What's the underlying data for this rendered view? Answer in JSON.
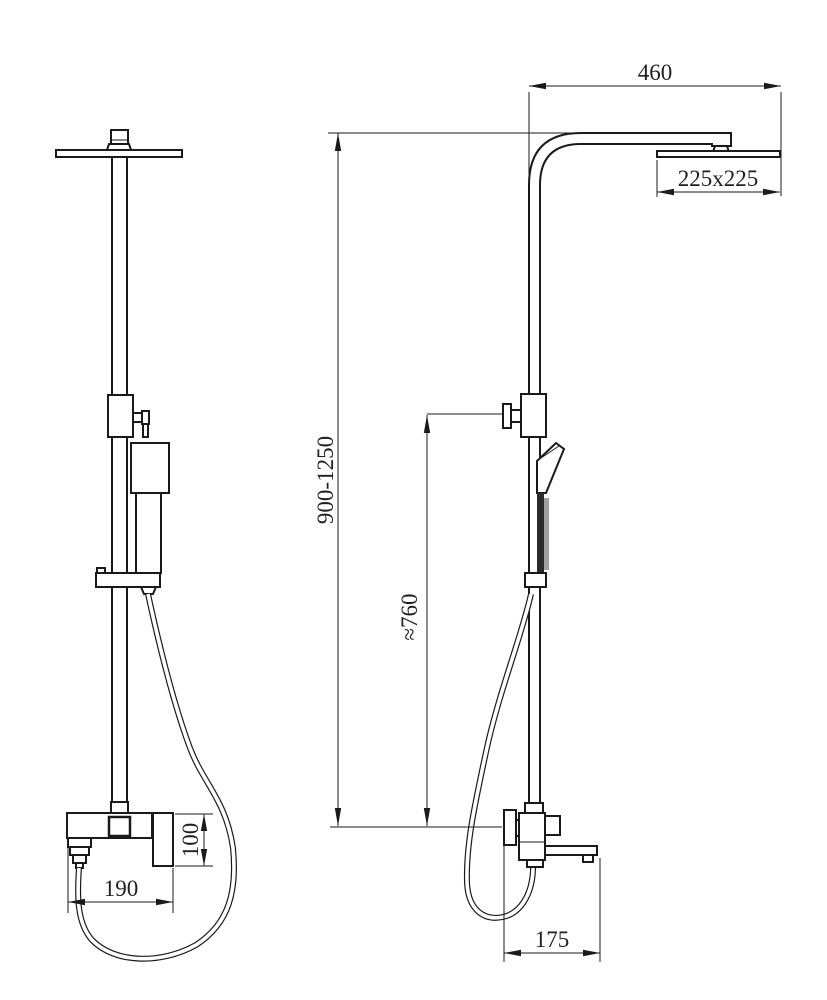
{
  "page": {
    "background": "#ffffff",
    "line_color": "#1a1a1a",
    "text_color": "#1f1f1f"
  },
  "dimensions": {
    "arm_length": "460",
    "head_size": "225x225",
    "riser_height_range": "900-1250",
    "hose_drop": "≈760",
    "mixer_width": "190",
    "mixer_height": "100",
    "spout_reach": "175"
  }
}
